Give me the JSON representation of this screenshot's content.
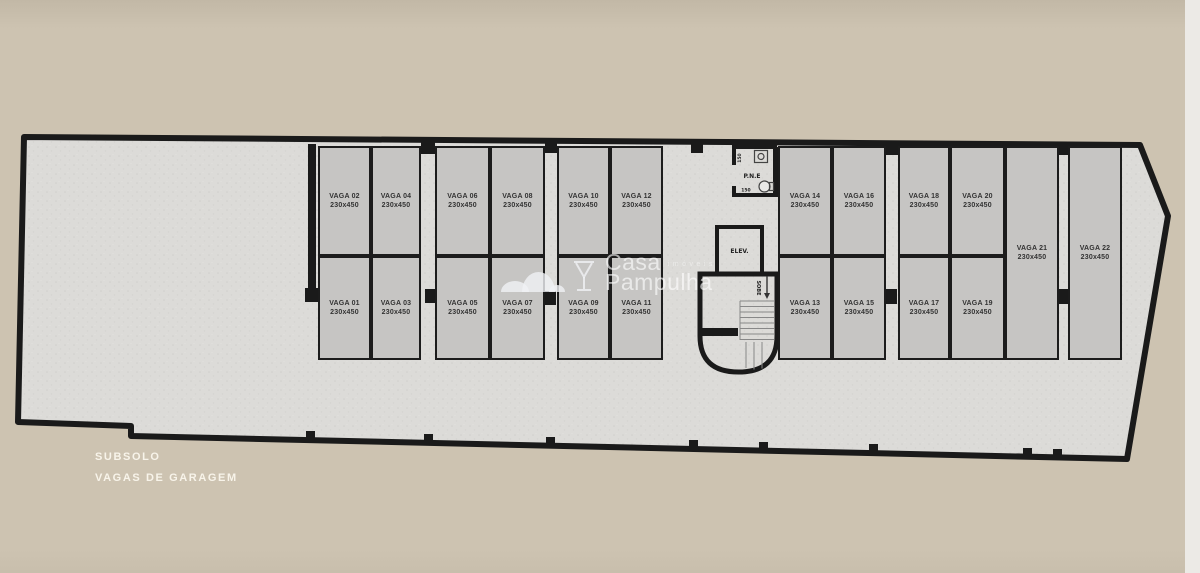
{
  "caption": {
    "line1": "SUBSOLO",
    "line2": "VAGAS DE GARAGEM"
  },
  "watermark": {
    "word1": "Casa",
    "word1_suffix": "imóveis",
    "word2": "Pampulha"
  },
  "core": {
    "elevator_label": "ELEV.",
    "wc_label": "P.N.E",
    "wc_dim_top": "150",
    "wc_dim_bottom": "150",
    "stairs_label": "SOBE"
  },
  "spots": [
    {
      "label": "VAGA 01",
      "size": "230x450"
    },
    {
      "label": "VAGA 02",
      "size": "230x450"
    },
    {
      "label": "VAGA 03",
      "size": "230x450"
    },
    {
      "label": "VAGA 04",
      "size": "230x450"
    },
    {
      "label": "VAGA 05",
      "size": "230x450"
    },
    {
      "label": "VAGA 06",
      "size": "230x450"
    },
    {
      "label": "VAGA 07",
      "size": "230x450"
    },
    {
      "label": "VAGA 08",
      "size": "230x450"
    },
    {
      "label": "VAGA 09",
      "size": "230x450"
    },
    {
      "label": "VAGA 10",
      "size": "230x450"
    },
    {
      "label": "VAGA 11",
      "size": "230x450"
    },
    {
      "label": "VAGA 12",
      "size": "230x450"
    },
    {
      "label": "VAGA 13",
      "size": "230x450"
    },
    {
      "label": "VAGA 14",
      "size": "230x450"
    },
    {
      "label": "VAGA 15",
      "size": "230x450"
    },
    {
      "label": "VAGA 16",
      "size": "230x450"
    },
    {
      "label": "VAGA 17",
      "size": "230x450"
    },
    {
      "label": "VAGA 18",
      "size": "230x450"
    },
    {
      "label": "VAGA 19",
      "size": "230x450"
    },
    {
      "label": "VAGA 20",
      "size": "230x450"
    },
    {
      "label": "VAGA 21",
      "size": "230x450"
    },
    {
      "label": "VAGA 22",
      "size": "230x450"
    }
  ],
  "colors": {
    "background": "#cdc3b1",
    "floor": "#dcdbd8",
    "spot_fill": "#c6c5c3",
    "wall": "#1a1a1a",
    "caption_text": "#f8f4ea",
    "watermark": "#ffffff"
  }
}
